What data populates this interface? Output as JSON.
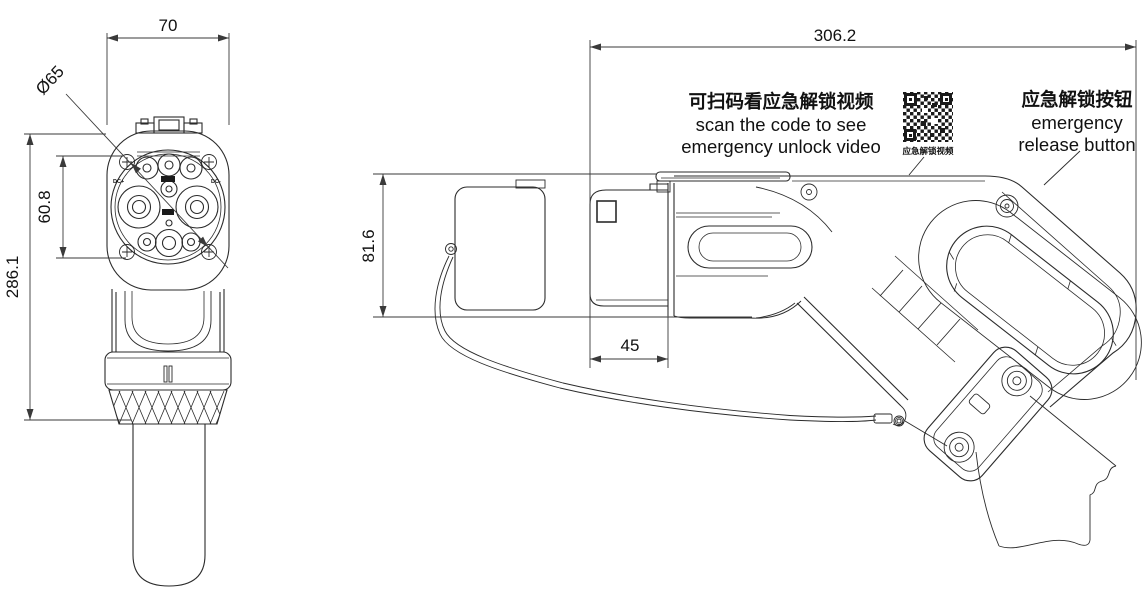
{
  "title": "EV charging connector dimensional drawing",
  "front_view": {
    "dim_width": "70",
    "dim_face_diameter": "Ø65",
    "dim_pin_pitch": "60.8",
    "dim_overall_height": "286.1",
    "label_dc_plus": "DC+",
    "label_dc_minus": "DC-"
  },
  "side_view": {
    "dim_overall_length": "306.2",
    "dim_height": "81.6",
    "dim_nozzle_length": "45"
  },
  "annotations": {
    "scan_note_zh": "可扫码看应急解锁视频",
    "scan_note_en_line1": "scan the code to see",
    "scan_note_en_line2": "emergency unlock video",
    "qr_caption": "应急解锁视频",
    "release_zh": "应急解锁按钮",
    "release_en_line1": "emergency",
    "release_en_line2": "release button"
  },
  "colors": {
    "line": "#2b2b2b",
    "dim": "#3a3a3a",
    "text": "#111111",
    "background": "#ffffff"
  }
}
